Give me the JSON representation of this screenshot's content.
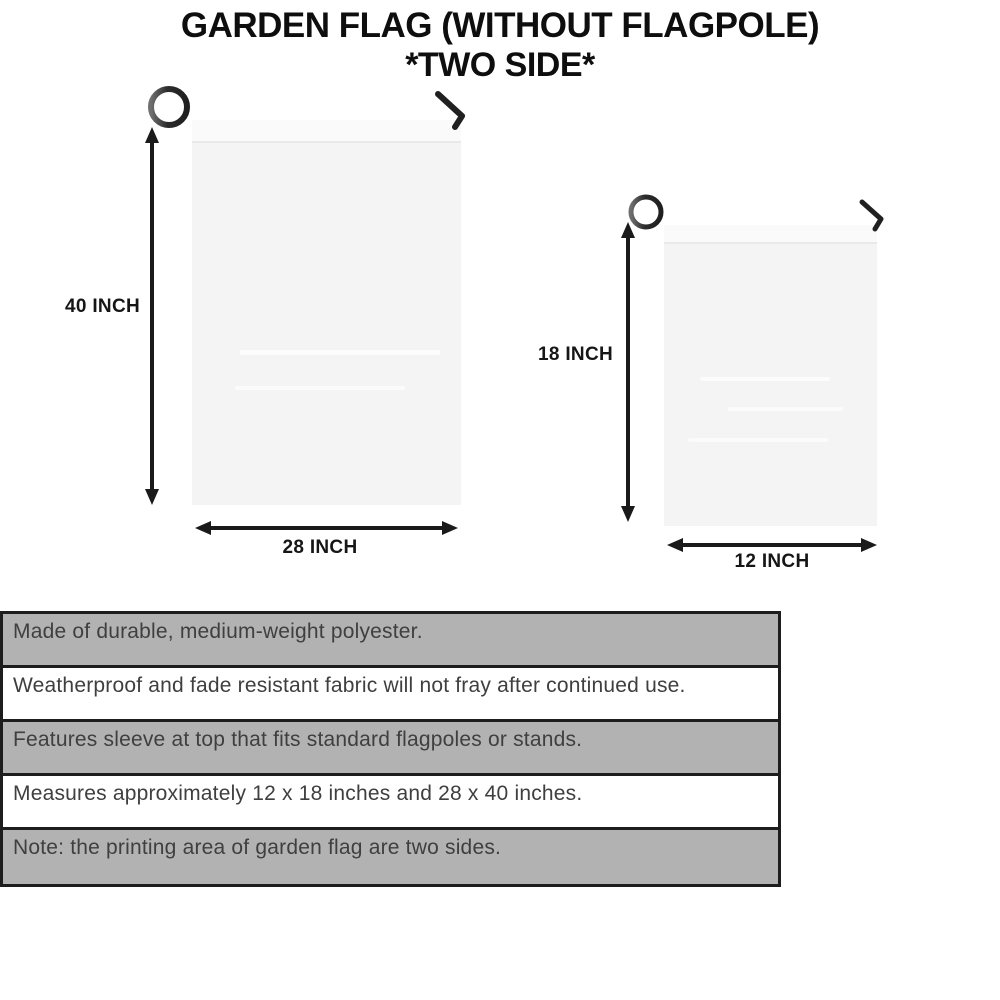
{
  "title": {
    "line1": "GARDEN FLAG (WITHOUT FLAGPOLE)",
    "line2": "*TWO SIDE*"
  },
  "diagram": {
    "large_flag": {
      "name": "28 x 40 inch garden flag",
      "height_label": "40 INCH",
      "width_label": "28 INCH"
    },
    "small_flag": {
      "name": "12 x 18 inch garden flag",
      "height_label": "18 INCH",
      "width_label": "12 INCH"
    }
  },
  "features": {
    "rows": [
      {
        "text": "Made of durable, medium-weight polyester."
      },
      {
        "text": "Weatherproof and fade resistant fabric will not fray after continued use."
      },
      {
        "text": "Features sleeve at top that fits standard flagpoles or stands."
      },
      {
        "text": "Measures approximately 12 x 18 inches and 28 x 40 inches."
      },
      {
        "text": "Note: the printing area of garden flag are two sides."
      }
    ]
  },
  "colors": {
    "background": "#ffffff",
    "title_text": "#0e0e0e",
    "table_gray_row": "#b2b2b2",
    "table_white_row": "#ffffff",
    "table_border": "#1d1d1d",
    "table_text": "#3f3f3f",
    "flag_fill": "#f4f4f5",
    "pole": "#3a3a3a",
    "arrow": "#1a1a1a"
  }
}
